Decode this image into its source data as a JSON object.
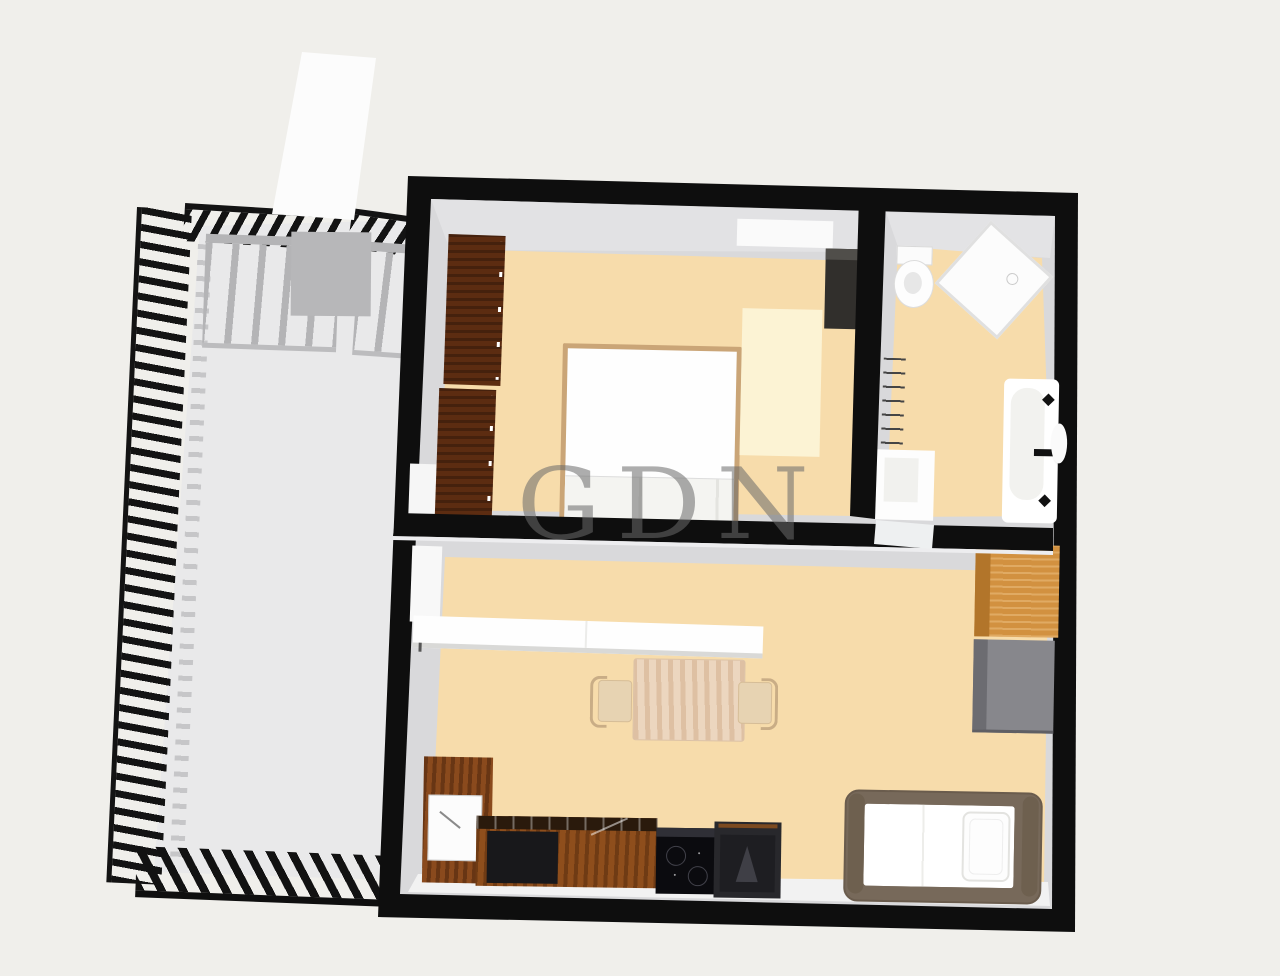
{
  "watermark": {
    "text": "GDN",
    "color": "rgba(105,105,105,0.55)"
  },
  "palette": {
    "bg": "#f0efeb",
    "wall": "#0e0e0e",
    "floor": "#f7dcab",
    "terraceFloor": "#e9e9ea",
    "innerFace": "#d9d9db",
    "faceLight": "#f2f2f2",
    "railGray": "#b4b4b6",
    "planterGray": "#b7b7b9",
    "rampWhite": "#fcfcfc",
    "woodDark": "#5c2c11",
    "woodKitchen": "#8a4a1d",
    "counterTop": "#2a1a0c",
    "applianceBlackPanel": "#18181b",
    "cooktopBlack": "#0b0b0f",
    "ovenDark": "#28282c",
    "orangeCabinet": "#d29140",
    "orangeCabinetSide": "#b2752a",
    "grayCabinet": "#87878c",
    "grayCabinetSide": "#6c6c71",
    "bedFrameTan": "#caa577",
    "singleBedFrame": "#77695a",
    "rugCream": "#fcf3d4",
    "tableWood": "#ecd6bf",
    "chairWood": "#e7d3b2",
    "darkCabinetBedroom": "#312f2c",
    "whiteFurniture": "#fdfdfd"
  }
}
